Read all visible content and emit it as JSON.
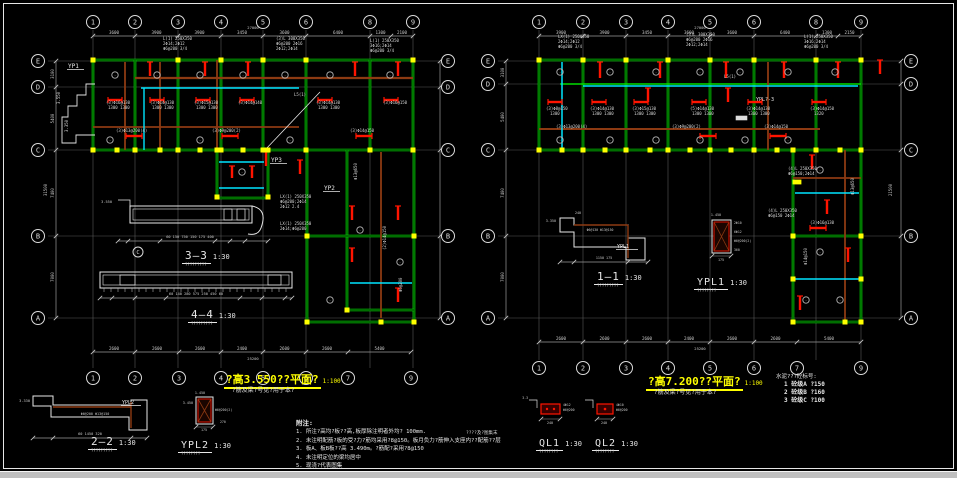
{
  "window": {
    "bg": "#000000",
    "frame": "#e6e6e6",
    "bottom_strip": "#bfbfbf"
  },
  "colors": {
    "wall": "#00dd00",
    "beam_red": "#ff1400",
    "beam_cyan": "#00e5ff",
    "beam_brown": "#8d3a12",
    "column": "#ffff00",
    "text": "#e0e0e0",
    "dim": "#c8c8c8",
    "grid": "#5a5a5a",
    "title": "#ffff00"
  },
  "titles": {
    "left": {
      "text": "?高3.550??平面?",
      "scale": "1:100",
      "subtitle": "?筋及梁?号见?用于本?"
    },
    "right": {
      "text": "?高7.200??平面?",
      "scale": "1:100",
      "subtitle": "?筋及梁?号见?用于本?"
    }
  },
  "notes": {
    "header": "附注:",
    "items": [
      "1. 所注?高均?板??高,板厚除注明者外均? 100mm.",
      "2. 未注明配筋?板的受?力?筋均采用?8@150。板月负力?筋伸入支座内??配筋??层",
      "3. 板A、板B板??高 3.490m。?筋配?采用?8@150",
      "4. 未注明定位的梁均居中",
      "5. 现浇?代表图集"
    ]
  },
  "legend": {
    "header": "水泥???砼标号:",
    "items": [
      "1  砼级A  ?150",
      "2  砼级B  ?160",
      "3  砼级C  ?100"
    ]
  },
  "misc": {
    "ql_note": "????及?图集末"
  },
  "sections": [
    {
      "label": "3—3",
      "scale": "1:30",
      "sub": "?????????"
    },
    {
      "label": "4—4",
      "scale": "1:30",
      "sub": "?????????"
    },
    {
      "label": "2—2",
      "scale": "1:30",
      "sub": "?????????"
    },
    {
      "label": "YPL2",
      "scale": "1:30",
      "sub": "????????"
    },
    {
      "label": "1—1",
      "scale": "1:30",
      "sub": "?????????"
    },
    {
      "label": "YPL1",
      "scale": "1:30",
      "sub": "????????"
    },
    {
      "label": "QL1",
      "scale": "1:30",
      "sub": "????????"
    },
    {
      "label": "QL2",
      "scale": "1:30",
      "sub": "????????"
    }
  ],
  "details": {
    "d33": {
      "level": "3.550",
      "dims": "60 150  750  150 175 400"
    },
    "d44": {
      "dims": "60 140 280   575   250 450 60"
    },
    "d22": {
      "level": "3.330",
      "dims": "60   1450   320",
      "inner": "YPL2"
    },
    "dypl2": {
      "top": "1.450",
      "left": "3.450",
      "right": "Φ6@200(2)",
      "bottom": "175",
      "side": "270"
    },
    "d11": {
      "level": "3.350",
      "top": "240",
      "labels": "Φ6@130 Φ13@150",
      "dims": "1150    175",
      "inner": "YPL1"
    },
    "dypl1": {
      "top": "1.450",
      "right": [
        "2Φ10",
        "6Φ12",
        "Φ6@200(2)",
        "360"
      ],
      "bottom": "175"
    },
    "dql1": {
      "level": "3.3",
      "right": [
        "4Φ12",
        "Φ6@200"
      ],
      "bottom": "240"
    },
    "dql2": {
      "level": "3.3",
      "right": [
        "4Φ10",
        "Φ6@200"
      ],
      "bottom": "240"
    }
  },
  "left_plan": {
    "top_axes": {
      "labels": [
        "1",
        "2",
        "3",
        "4",
        "5",
        "6",
        "8",
        "9"
      ],
      "x": [
        93,
        135,
        178,
        221,
        263,
        306,
        370,
        413
      ]
    },
    "top_dims": {
      "segments": [
        "3600",
        "3900",
        "3900",
        "3450",
        "3600",
        "6400",
        "1300",
        "2100"
      ],
      "overall": "27000"
    },
    "bottom_axes": {
      "labels": [
        "1",
        "2",
        "3",
        "4",
        "5",
        "6",
        "7",
        "9"
      ],
      "x": [
        93,
        135,
        179,
        221,
        263,
        306,
        348,
        411
      ]
    },
    "bottom_dims": {
      "segments": [
        "2600",
        "2600",
        "2600",
        "2400",
        "2600",
        "2600",
        "5400"
      ],
      "overall": "25200"
    },
    "side_axes": {
      "labels": [
        "E",
        "D",
        "C",
        "B",
        "A"
      ],
      "y": [
        61,
        87,
        150,
        236,
        318
      ]
    },
    "side_dims": {
      "segments": [
        "3100",
        "5400",
        "7400",
        "7000"
      ],
      "overall": "31500"
    },
    "labels": [
      {
        "t": "YP1",
        "x": 68,
        "y": 64
      },
      {
        "t": "YP3",
        "x": 271,
        "y": 158
      },
      {
        "t": "YP2",
        "x": 324,
        "y": 186
      }
    ],
    "callouts": [
      {
        "t": "L(1) 250X350",
        "x": 163,
        "y": 40
      },
      {
        "t": "2Φ14;2Φ12",
        "x": 163,
        "y": 45
      },
      {
        "t": "Φ6@200 3/4",
        "x": 163,
        "y": 50
      },
      {
        "t": "(3)L 300X350",
        "x": 276,
        "y": 40
      },
      {
        "t": "Φ6@200 2Φ16",
        "x": 276,
        "y": 45
      },
      {
        "t": "2Φ12;2Φ14",
        "x": 276,
        "y": 50
      },
      {
        "t": "L(1) 250X350",
        "x": 370,
        "y": 42
      },
      {
        "t": "3Φ16;2Φ14",
        "x": 370,
        "y": 47
      },
      {
        "t": "Φ6@200 3/4",
        "x": 370,
        "y": 52
      },
      {
        "t": "(3)Φ16@130",
        "x": 106,
        "y": 104
      },
      {
        "t": "1300 1300",
        "x": 108,
        "y": 109
      },
      {
        "t": "(3)Φ14@130",
        "x": 150,
        "y": 104
      },
      {
        "t": "1300 1300",
        "x": 152,
        "y": 109
      },
      {
        "t": "(3)Φ15@130",
        "x": 194,
        "y": 104
      },
      {
        "t": "1300 1300",
        "x": 196,
        "y": 109
      },
      {
        "t": "(3)Φ14@140",
        "x": 238,
        "y": 104
      },
      {
        "t": "(3)Φ14@130",
        "x": 316,
        "y": 104
      },
      {
        "t": "1300 1300",
        "x": 318,
        "y": 109
      },
      {
        "t": "(3)Φ16@150",
        "x": 383,
        "y": 104
      },
      {
        "t": "(3)Φ13@200(4)",
        "x": 116,
        "y": 132
      },
      {
        "t": "(3)Φ9@200(2)",
        "x": 212,
        "y": 132
      },
      {
        "t": "(3)Φ14@150",
        "x": 350,
        "y": 132
      },
      {
        "t": "L5(1)",
        "x": 294,
        "y": 96
      },
      {
        "t": "LX(1) 250X350",
        "x": 280,
        "y": 198
      },
      {
        "t": "Φ6@200;2Φ14",
        "x": 280,
        "y": 203
      },
      {
        "t": "2Φ12 2.4",
        "x": 280,
        "y": 208
      },
      {
        "t": "LX(1) 250X350",
        "x": 280,
        "y": 225
      },
      {
        "t": "2Φ14;Φ6@200",
        "x": 280,
        "y": 230
      },
      {
        "t": "3.550",
        "x": 60,
        "y": 104,
        "r": -90
      },
      {
        "t": "3.350",
        "x": 68,
        "y": 132,
        "r": -90
      },
      {
        "t": "Φ13@650",
        "x": 357,
        "y": 180,
        "r": -90
      },
      {
        "t": "(2)Φ14@150",
        "x": 386,
        "y": 250,
        "r": -90
      },
      {
        "t": "Φ6@200",
        "x": 402,
        "y": 292,
        "r": -90
      }
    ]
  },
  "right_plan": {
    "top_axes": {
      "labels": [
        "1",
        "2",
        "3",
        "4",
        "5",
        "6",
        "8",
        "9"
      ],
      "x": [
        539,
        583,
        626,
        668,
        710,
        754,
        816,
        861
      ]
    },
    "top_dims": {
      "segments": [
        "3900",
        "3900",
        "3450",
        "3600",
        "3600",
        "6400",
        "1300",
        "2150"
      ],
      "overall": "27000"
    },
    "bottom_axes": {
      "labels": [
        "1",
        "2",
        "3",
        "4",
        "5",
        "6",
        "7",
        "9"
      ],
      "x": [
        539,
        583,
        626,
        668,
        710,
        754,
        797,
        861
      ]
    },
    "bottom_dims": {
      "segments": [
        "2600",
        "2600",
        "2600",
        "2400",
        "2600",
        "2600",
        "5400"
      ],
      "overall": "25200"
    },
    "side_axes": {
      "labels": [
        "E",
        "D",
        "C",
        "B",
        "A"
      ],
      "y": [
        61,
        84,
        150,
        236,
        318
      ]
    },
    "side_dims": {
      "segments": [
        "3100",
        "5400",
        "7400",
        "7000"
      ],
      "overall": "21500"
    },
    "labels": [
      {
        "t": "YPL?-3",
        "x": 756,
        "y": 97
      }
    ],
    "callouts": [
      {
        "t": "LX(1) 250X350",
        "x": 558,
        "y": 38
      },
      {
        "t": "2Φ14;2Φ12",
        "x": 558,
        "y": 43
      },
      {
        "t": "Φ6@200 3/4",
        "x": 558,
        "y": 48
      },
      {
        "t": "(3)L 300X350",
        "x": 686,
        "y": 36
      },
      {
        "t": "Φ6@200 2Φ16",
        "x": 686,
        "y": 41
      },
      {
        "t": "2Φ12;2Φ14",
        "x": 686,
        "y": 46
      },
      {
        "t": "L(1) 250X350",
        "x": 804,
        "y": 38
      },
      {
        "t": "3Φ16;2Φ14",
        "x": 804,
        "y": 43
      },
      {
        "t": "Φ6@200 3/4",
        "x": 804,
        "y": 48
      },
      {
        "t": "(3)Φ8@150",
        "x": 546,
        "y": 110
      },
      {
        "t": "1300",
        "x": 550,
        "y": 115
      },
      {
        "t": "(3)Φ14@130",
        "x": 590,
        "y": 110
      },
      {
        "t": "1300 1300",
        "x": 592,
        "y": 115
      },
      {
        "t": "(3)Φ15@130",
        "x": 632,
        "y": 110
      },
      {
        "t": "1300 1300",
        "x": 634,
        "y": 115
      },
      {
        "t": "(5)Φ14@130",
        "x": 690,
        "y": 110
      },
      {
        "t": "1300 1300",
        "x": 692,
        "y": 115
      },
      {
        "t": "(3)Φ14@130",
        "x": 746,
        "y": 110
      },
      {
        "t": "1300 1300",
        "x": 748,
        "y": 115
      },
      {
        "t": "(3)Φ14@150",
        "x": 810,
        "y": 110
      },
      {
        "t": "1320",
        "x": 814,
        "y": 115
      },
      {
        "t": "(3)Φ13@200(4)",
        "x": 556,
        "y": 128
      },
      {
        "t": "(3)Φ9@200(2)",
        "x": 672,
        "y": 128
      },
      {
        "t": "(3)Φ14@150",
        "x": 764,
        "y": 128
      },
      {
        "t": "L5(1)",
        "x": 724,
        "y": 78
      },
      {
        "t": "(4)L 250X350",
        "x": 788,
        "y": 170
      },
      {
        "t": "Φ6@150;2Φ14",
        "x": 788,
        "y": 175
      },
      {
        "t": "(4)L 250X350",
        "x": 768,
        "y": 212
      },
      {
        "t": "Φ6@150 2Φ14",
        "x": 768,
        "y": 217
      },
      {
        "t": "(3)Φ16@130",
        "x": 810,
        "y": 224
      },
      {
        "t": "Φ13@650",
        "x": 854,
        "y": 195,
        "r": -90
      },
      {
        "t": "Φ14@150",
        "x": 807,
        "y": 265,
        "r": -90
      }
    ]
  }
}
